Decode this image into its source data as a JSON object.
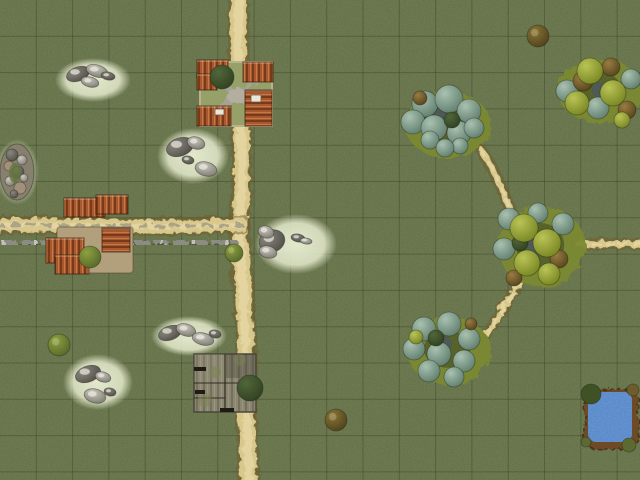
{
  "scene": {
    "type": "tabletop-battlemap",
    "width": 640,
    "height": 480,
    "grid": {
      "size": 36.3,
      "color": "rgba(10,18,6,0.22)"
    }
  },
  "colors": {
    "grass": "#5f6b44",
    "grain_dark": "0 0 0 0 0.14  0 0 0 0 0.19  0 0 0 0 0.07  0 0 0 0.6 0",
    "grain_light": "0 0 0 0 0.55  0 0 0 0 0.60  0 0 0 0 0.38  0 0 0 0.35 0",
    "road_core": "#d8c88c",
    "road_light": "#e6d6a2",
    "road_edge": "rgba(112,90,46,0.5)",
    "road_center_gray": "#9e9783",
    "wall_stone": "#8c8c84",
    "wall_light": "#c2c2b8",
    "roof_base": "#a8582e",
    "roof_dark": "#7a3a1a",
    "roof_light": "#c47a48",
    "farm_courtyard": "#96a069",
    "farm_border": "#bcb08d",
    "gravel": "#a7a293",
    "gravel_light": "#b3aea0",
    "tan_courtyard": "#b2a07d",
    "barn_base": "#8b8672",
    "barn_dark": "#756f5c",
    "barn_light": "#9a957e",
    "barn_moss": "rgba(122,130,84,0.5)",
    "patch_light": "#e9eed2",
    "rock_light": "#cdcac0",
    "rock_dark_edge": "#7b786f",
    "rock_deep": "#4f4d46",
    "rock_deep_light": "#8a877e",
    "cluster_base": "#7c8a33",
    "cluster_hollow": "#3f4b26",
    "tree_sage": [
      "#a9c1b1",
      "#5c7a6a"
    ],
    "tree_lime": [
      "#b9c456",
      "#75821f"
    ],
    "tree_brown": [
      "#9a7c42",
      "#53421c"
    ],
    "tree_dark": [
      "#52663a",
      "#2e4020"
    ],
    "tree_shadow": "rgba(72,82,122,0.55)",
    "bush_green": [
      "#8ea03f",
      "#53662a"
    ],
    "bush_brown": [
      "#8a7435",
      "#4d3f1c"
    ],
    "sign": "#e9e7da",
    "pond_rim": "#6e4b28",
    "pond_water": "#4c80c4"
  },
  "roads": [
    {
      "name": "road-vertical-main",
      "d": "M 237,-6 C 233,70 244,140 239,200 C 236,260 247,330 245,390 C 244,430 248,462 247,486",
      "w": 16,
      "gray": false
    },
    {
      "name": "road-horizontal-left",
      "d": "M -6,224 C 70,221 150,227 240,223",
      "w": 13,
      "gray": true
    },
    {
      "name": "path-upper-right",
      "d": "M 480,149 C 492,168 500,186 508,207",
      "w": 6,
      "gray": false
    },
    {
      "name": "path-right-east",
      "d": "M 576,242 L 646,243",
      "w": 7,
      "gray": false
    },
    {
      "name": "path-right-south",
      "d": "M 518,280 C 508,296 496,314 486,331",
      "w": 6,
      "gray": false
    }
  ],
  "wall": {
    "name": "stone-wall",
    "x1": 0,
    "x2": 236,
    "y": 241
  },
  "rock_patches": [
    {
      "cx": 93,
      "cy": 80,
      "rx": 38,
      "ry": 22,
      "rocks": [
        [
          78,
          74,
          12,
          7
        ],
        [
          97,
          71,
          11,
          6
        ],
        [
          90,
          82,
          9,
          5
        ],
        [
          108,
          76,
          7,
          4
        ]
      ]
    },
    {
      "cx": 193,
      "cy": 156,
      "rx": 36,
      "ry": 28,
      "rocks": [
        [
          180,
          147,
          14,
          9
        ],
        [
          196,
          143,
          9,
          6
        ],
        [
          206,
          169,
          11,
          7
        ],
        [
          188,
          160,
          6,
          4
        ]
      ]
    },
    {
      "cx": 296,
      "cy": 244,
      "rx": 41,
      "ry": 30,
      "rocks": [
        [
          272,
          241,
          13,
          11
        ],
        [
          266,
          232,
          8,
          6
        ],
        [
          268,
          252,
          9,
          6
        ],
        [
          298,
          238,
          7,
          4
        ],
        [
          306,
          241,
          6,
          3
        ]
      ]
    },
    {
      "cx": 189,
      "cy": 336,
      "rx": 38,
      "ry": 20,
      "rocks": [
        [
          170,
          333,
          12,
          7
        ],
        [
          186,
          330,
          10,
          6
        ],
        [
          203,
          339,
          11,
          6
        ],
        [
          215,
          334,
          6,
          4
        ]
      ]
    },
    {
      "cx": 98,
      "cy": 382,
      "rx": 35,
      "ry": 28,
      "rocks": [
        [
          88,
          374,
          13,
          8
        ],
        [
          103,
          377,
          8,
          5
        ],
        [
          95,
          396,
          11,
          7
        ],
        [
          110,
          392,
          6,
          4
        ]
      ]
    }
  ],
  "outcrop": {
    "cx": 17,
    "cy": 172,
    "rx": 17,
    "ry": 28,
    "stones": [
      [
        12,
        155,
        6
      ],
      [
        22,
        160,
        5
      ],
      [
        9,
        166,
        5
      ],
      [
        18,
        172,
        6
      ],
      [
        10,
        181,
        5
      ],
      [
        20,
        188,
        6
      ],
      [
        14,
        194,
        4
      ],
      [
        24,
        178,
        4
      ]
    ],
    "moss": [
      15,
      173,
      6,
      10
    ]
  },
  "farm": {
    "courtyard": [
      200,
      62,
      72,
      64
    ],
    "x_paths": [
      [
        207,
        71,
        265,
        117
      ],
      [
        264,
        70,
        207,
        117
      ]
    ],
    "center_blob": [
      236,
      94,
      11,
      8
    ],
    "buildings": [
      {
        "r": [
          197,
          60,
          31,
          18
        ],
        "pat": "V"
      },
      {
        "r": [
          197,
          74,
          20,
          16
        ],
        "pat": "V"
      },
      {
        "r": [
          243,
          62,
          30,
          20
        ],
        "pat": "V"
      },
      {
        "r": [
          197,
          106,
          34,
          20
        ],
        "pat": "V"
      },
      {
        "r": [
          245,
          90,
          27,
          36
        ],
        "pat": "H"
      }
    ],
    "signs": [
      [
        215,
        109,
        9,
        6
      ],
      [
        251,
        95,
        10,
        7
      ]
    ],
    "tree": [
      222,
      77,
      12
    ]
  },
  "complex": {
    "courtyard": [
      57,
      227,
      76,
      46
    ],
    "buildings": [
      {
        "r": [
          64,
          198,
          41,
          19
        ],
        "pat": "V"
      },
      {
        "r": [
          96,
          195,
          32,
          19
        ],
        "pat": "V"
      },
      {
        "r": [
          46,
          238,
          38,
          25
        ],
        "pat": "V"
      },
      {
        "r": [
          55,
          255,
          34,
          19
        ],
        "pat": "V"
      },
      {
        "r": [
          102,
          228,
          28,
          24
        ],
        "pat": "H"
      }
    ],
    "bush": [
      90,
      257,
      11
    ]
  },
  "barn": {
    "body": [
      194,
      354,
      62,
      58
    ],
    "seams": [
      [
        225,
        354,
        225,
        412
      ],
      [
        194,
        383,
        256,
        383
      ],
      [
        194,
        398,
        225,
        398
      ]
    ],
    "shade_dark": [
      226,
      354,
      30,
      24
    ],
    "shade_light": [
      194,
      354,
      32,
      28
    ],
    "moss": [
      [
        205,
        400,
        7
      ],
      [
        240,
        360,
        6
      ],
      [
        215,
        372,
        6
      ]
    ],
    "slits": [
      [
        194,
        367,
        12,
        4
      ],
      [
        195,
        390,
        10,
        4
      ],
      [
        220,
        408,
        14,
        4
      ]
    ],
    "tree": [
      250,
      388,
      13
    ]
  },
  "tree_clusters": [
    {
      "name": "tree-cluster-north",
      "base": [
        446,
        123,
        43,
        33
      ],
      "trees": [
        [
          443,
          115,
          9,
          "h"
        ],
        [
          425,
          104,
          13,
          "s"
        ],
        [
          449,
          99,
          14,
          "s"
        ],
        [
          469,
          111,
          12,
          "s"
        ],
        [
          413,
          122,
          12,
          "s"
        ],
        [
          434,
          128,
          13,
          "s"
        ],
        [
          459,
          133,
          12,
          "s"
        ],
        [
          474,
          128,
          10,
          "s"
        ],
        [
          420,
          98,
          7,
          "b"
        ],
        [
          452,
          120,
          8,
          "d"
        ],
        [
          430,
          140,
          9,
          "s"
        ],
        [
          460,
          146,
          8,
          "s"
        ],
        [
          445,
          148,
          9,
          "s"
        ]
      ]
    },
    {
      "name": "tree-cluster-northeast",
      "base": [
        598,
        89,
        42,
        32
      ],
      "trees": [
        [
          600,
          90,
          8,
          "h"
        ],
        [
          567,
          91,
          11,
          "s"
        ],
        [
          598,
          108,
          11,
          "s"
        ],
        [
          631,
          79,
          10,
          "s"
        ],
        [
          583,
          81,
          10,
          "b"
        ],
        [
          611,
          67,
          9,
          "b"
        ],
        [
          627,
          110,
          9,
          "b"
        ],
        [
          590,
          71,
          13,
          "l"
        ],
        [
          613,
          93,
          13,
          "l"
        ],
        [
          577,
          103,
          12,
          "l"
        ],
        [
          622,
          120,
          8,
          "l"
        ]
      ]
    },
    {
      "name": "tree-cluster-east",
      "base": [
        540,
        245,
        44,
        40
      ],
      "trees": [
        [
          536,
          246,
          9,
          "h"
        ],
        [
          509,
          219,
          11,
          "s"
        ],
        [
          563,
          224,
          11,
          "s"
        ],
        [
          504,
          249,
          11,
          "s"
        ],
        [
          538,
          213,
          10,
          "s"
        ],
        [
          520,
          243,
          8,
          "d"
        ],
        [
          559,
          259,
          9,
          "b"
        ],
        [
          514,
          278,
          8,
          "b"
        ],
        [
          524,
          228,
          14,
          "l"
        ],
        [
          547,
          243,
          14,
          "l"
        ],
        [
          527,
          263,
          13,
          "l"
        ],
        [
          549,
          274,
          11,
          "l"
        ]
      ]
    },
    {
      "name": "tree-cluster-southeast",
      "base": [
        447,
        349,
        42,
        34
      ],
      "trees": [
        [
          444,
          344,
          8,
          "h"
        ],
        [
          424,
          329,
          12,
          "s"
        ],
        [
          449,
          324,
          12,
          "s"
        ],
        [
          469,
          339,
          11,
          "s"
        ],
        [
          414,
          349,
          11,
          "s"
        ],
        [
          439,
          354,
          12,
          "s"
        ],
        [
          464,
          361,
          11,
          "s"
        ],
        [
          429,
          371,
          11,
          "s"
        ],
        [
          454,
          377,
          10,
          "s"
        ],
        [
          471,
          324,
          6,
          "b"
        ],
        [
          416,
          337,
          7,
          "l"
        ],
        [
          436,
          338,
          8,
          "d"
        ]
      ]
    }
  ],
  "bushes": [
    {
      "x": 538,
      "y": 36,
      "r": 11,
      "type": "brown",
      "name": "bush-northeast"
    },
    {
      "x": 336,
      "y": 420,
      "r": 11,
      "type": "brown",
      "name": "bush-south"
    },
    {
      "x": 59,
      "y": 345,
      "r": 11,
      "type": "green",
      "name": "bush-west"
    },
    {
      "x": 234,
      "y": 253,
      "r": 9,
      "type": "green",
      "name": "bush-roadside"
    }
  ],
  "pond": {
    "rim": [
      583,
      387,
      54,
      60
    ],
    "water": [
      588,
      392,
      44,
      50
    ],
    "bushes": [
      [
        591,
        394,
        10,
        "#3e5226"
      ],
      [
        633,
        390,
        6,
        "#6e5c2c"
      ],
      [
        586,
        442,
        5,
        "#5c6a31"
      ],
      [
        629,
        445,
        7,
        "#5c6a31"
      ]
    ]
  }
}
